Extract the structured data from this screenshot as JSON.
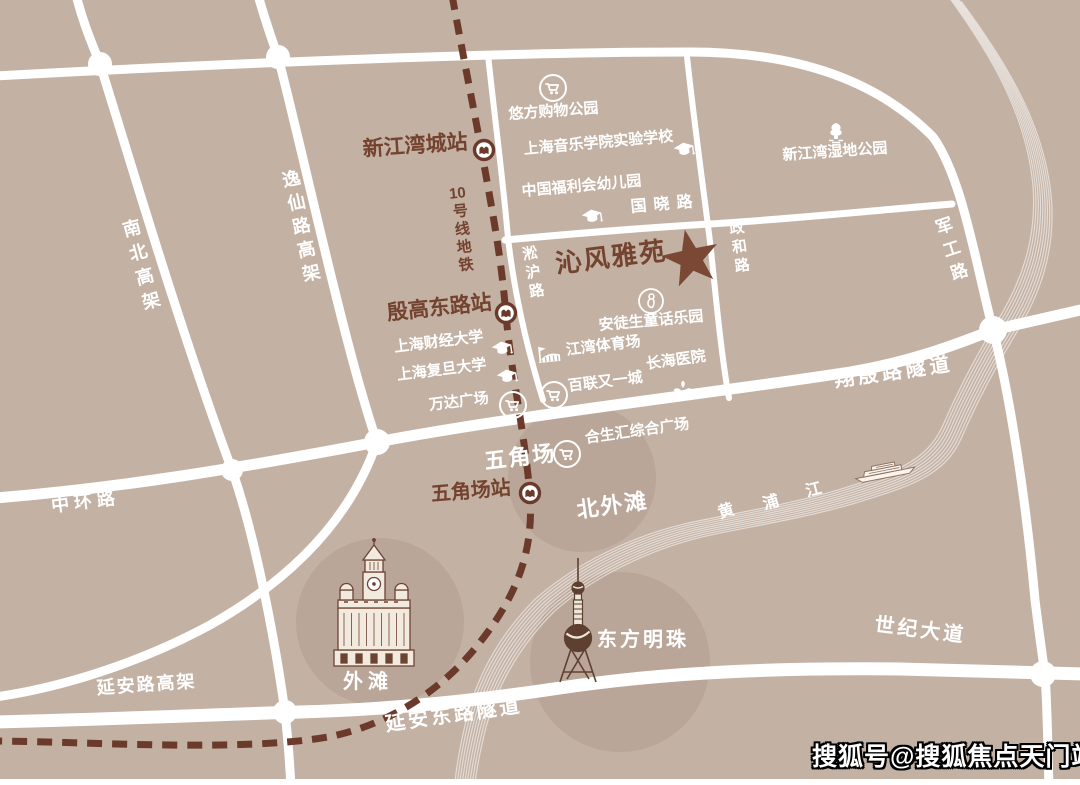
{
  "colors": {
    "background": "#c3b1a4",
    "road": "#ffffff",
    "brown_text": "#74432f",
    "metro_line": "#6b3a2a",
    "star": "#7b4836"
  },
  "map": {
    "project": {
      "name": "沁风雅苑"
    },
    "metro": {
      "line_label": "10号线地铁",
      "line_number": "10",
      "line_label_suffix": "号线地铁",
      "stations": {
        "xinjiangwancheng": "新江湾城站",
        "yingaodonglu": "殷高东路站",
        "wujiaochang": "五角场站"
      }
    },
    "roads": {
      "nanbei_gaojia": "南北高架",
      "yixianlu_gaojia": "逸仙路高架",
      "zhonghuanlu": "中环路",
      "guoxiaolu": "国晓路",
      "songhulu": "淞沪路",
      "zhenghelu": "政和路",
      "jungonglu": "军工路",
      "xiangyinlu_suidao": "翔殷路隧道",
      "yananlu_gaojia": "延安路高架",
      "yanandonglu_suidao": "延安东路隧道",
      "shijidadao": "世纪大道"
    },
    "river": {
      "name": "黄浦江",
      "chars": [
        "黄",
        "浦",
        "江"
      ]
    },
    "areas": {
      "beiwaitan": "北外滩",
      "wujiaochang": "五角场",
      "waitan": "外滩",
      "dongfangmingzhu": "东方明珠"
    },
    "pois": {
      "youfang": "悠方购物公园",
      "music_school": "上海音乐学院实验学校",
      "kindergarten": "中国福利会幼儿园",
      "wetland_park": "新江湾湿地公园",
      "andersen_park": "安徒生童话乐园",
      "caijing_univ": "上海财经大学",
      "fudan_univ": "上海复旦大学",
      "wanda_plaza": "万达广场",
      "jiangwan_stadium": "江湾体育场",
      "changhai_hospital": "长海医院",
      "bailian": "百联又一城",
      "hesheng_hui": "合生汇综合广场"
    }
  },
  "watermark": {
    "text": "搜狐号@搜狐焦点天门站"
  }
}
